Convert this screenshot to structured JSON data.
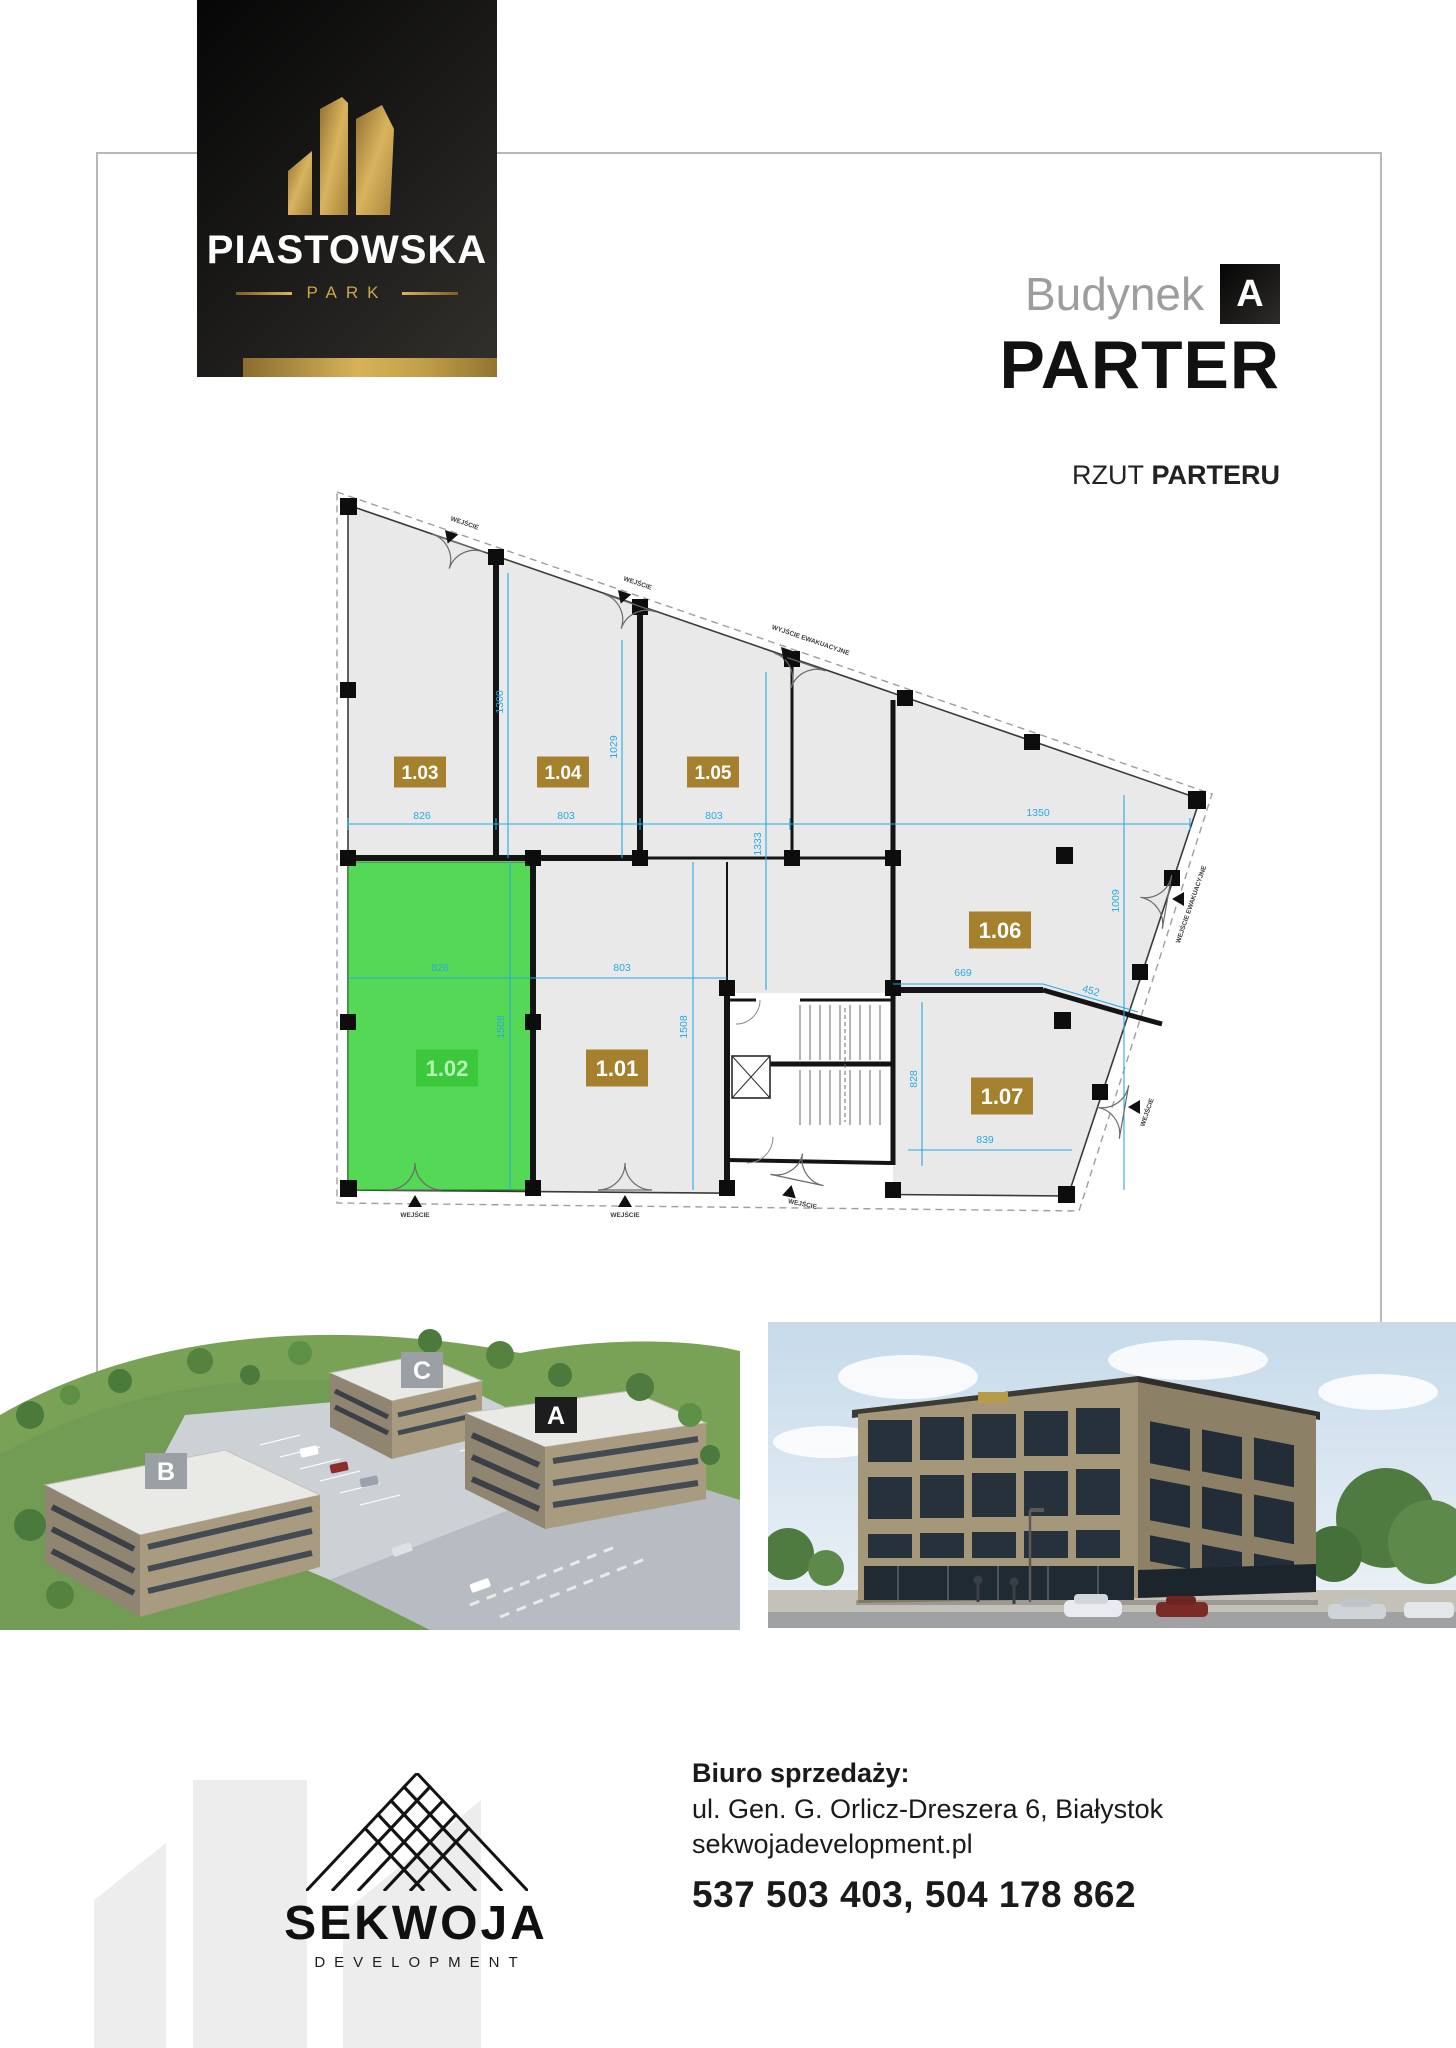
{
  "brand": {
    "name": "PIASTOWSKA",
    "park": "PARK"
  },
  "header": {
    "building_label": "Budynek",
    "building_letter": "A",
    "floor_title": "PARTER",
    "plan_label_regular": "RZUT",
    "plan_label_bold": "PARTERU"
  },
  "colors": {
    "gold_chip": "#a5812d",
    "highlight_chip": "#3cc83c",
    "highlight_text": "#b5f4b5",
    "green_fill": "#55d855",
    "dim_blue": "#29a9e2",
    "wall_black": "#141414"
  },
  "floor_plan": {
    "highlighted_unit": "1.02",
    "units": [
      {
        "id": "1.03",
        "x": 420,
        "y": 772,
        "w": 52,
        "h": 31,
        "f": 19,
        "highlighted": false
      },
      {
        "id": "1.04",
        "x": 563,
        "y": 772,
        "w": 52,
        "h": 31,
        "f": 19,
        "highlighted": false
      },
      {
        "id": "1.05",
        "x": 713,
        "y": 772,
        "w": 52,
        "h": 31,
        "f": 19,
        "highlighted": false
      },
      {
        "id": "1.06",
        "x": 1000,
        "y": 930,
        "w": 62,
        "h": 37,
        "f": 22,
        "highlighted": false
      },
      {
        "id": "1.02",
        "x": 447,
        "y": 1068,
        "w": 62,
        "h": 37,
        "f": 22,
        "highlighted": true
      },
      {
        "id": "1.01",
        "x": 617,
        "y": 1068,
        "w": 62,
        "h": 37,
        "f": 22,
        "highlighted": false
      },
      {
        "id": "1.07",
        "x": 1002,
        "y": 1096,
        "w": 62,
        "h": 37,
        "f": 22,
        "highlighted": false
      }
    ],
    "dims": [
      {
        "v": "826",
        "x": 422,
        "y": 819
      },
      {
        "v": "803",
        "x": 566,
        "y": 819
      },
      {
        "v": "803",
        "x": 714,
        "y": 819
      },
      {
        "v": "1350",
        "x": 1038,
        "y": 816
      },
      {
        "v": "1300",
        "x": 503,
        "y": 702,
        "r": -90
      },
      {
        "v": "1029",
        "x": 617,
        "y": 747,
        "r": -90
      },
      {
        "v": "1333",
        "x": 761,
        "y": 844,
        "r": -90
      },
      {
        "v": "1009",
        "x": 1119,
        "y": 901,
        "r": -90
      },
      {
        "v": "826",
        "x": 440,
        "y": 971
      },
      {
        "v": "803",
        "x": 622,
        "y": 971
      },
      {
        "v": "1508",
        "x": 504,
        "y": 1027,
        "r": -90
      },
      {
        "v": "1508",
        "x": 687,
        "y": 1027,
        "r": -90
      },
      {
        "v": "669",
        "x": 963,
        "y": 976
      },
      {
        "v": "452",
        "x": 1090,
        "y": 994,
        "r": 16
      },
      {
        "v": "828",
        "x": 917,
        "y": 1079,
        "r": -90
      },
      {
        "v": "839",
        "x": 985,
        "y": 1143
      }
    ],
    "doors": [
      {
        "label": "WEJŚCIE",
        "x": 464,
        "y": 525,
        "r": 19,
        "tx": 450,
        "ty": 537,
        "tr": 19
      },
      {
        "label": "WEJŚCIE",
        "x": 637,
        "y": 585,
        "r": 19,
        "tx": 623,
        "ty": 597,
        "tr": 19
      },
      {
        "label": "WYJŚCIE EWAKUACYJNE",
        "x": 810,
        "y": 642,
        "r": 19,
        "tx": 786,
        "ty": 654,
        "tr": 19
      },
      {
        "label": "WEJŚCIE EWAKUACYJNE",
        "x": 1193,
        "y": 905,
        "r": -71,
        "tx": 1179,
        "ty": 899,
        "tr": 90
      },
      {
        "label": "WEJŚCIE",
        "x": 1149,
        "y": 1113,
        "r": -71,
        "tx": 1135,
        "ty": 1107,
        "tr": 90
      },
      {
        "label": "WEJŚCIE",
        "x": 415,
        "y": 1217,
        "r": 0,
        "tx": 415,
        "ty": 1202,
        "tr": 180
      },
      {
        "label": "WEJŚCIE",
        "x": 625,
        "y": 1217,
        "r": 0,
        "tx": 625,
        "ty": 1202,
        "tr": 180
      },
      {
        "label": "WEJŚCIE",
        "x": 802,
        "y": 1206,
        "r": 12,
        "tx": 790,
        "ty": 1192,
        "tr": 192
      }
    ]
  },
  "site": {
    "labels": [
      "B",
      "C",
      "A"
    ]
  },
  "footer": {
    "developer": "SEKWOJA",
    "developer_sub": "DEVELOPMENT",
    "office_heading": "Biuro sprzedaży:",
    "address": "ul. Gen. G. Orlicz-Dreszera 6, Białystok",
    "website": "sekwojadevelopment.pl",
    "phones": "537 503 403, 504 178 862"
  }
}
